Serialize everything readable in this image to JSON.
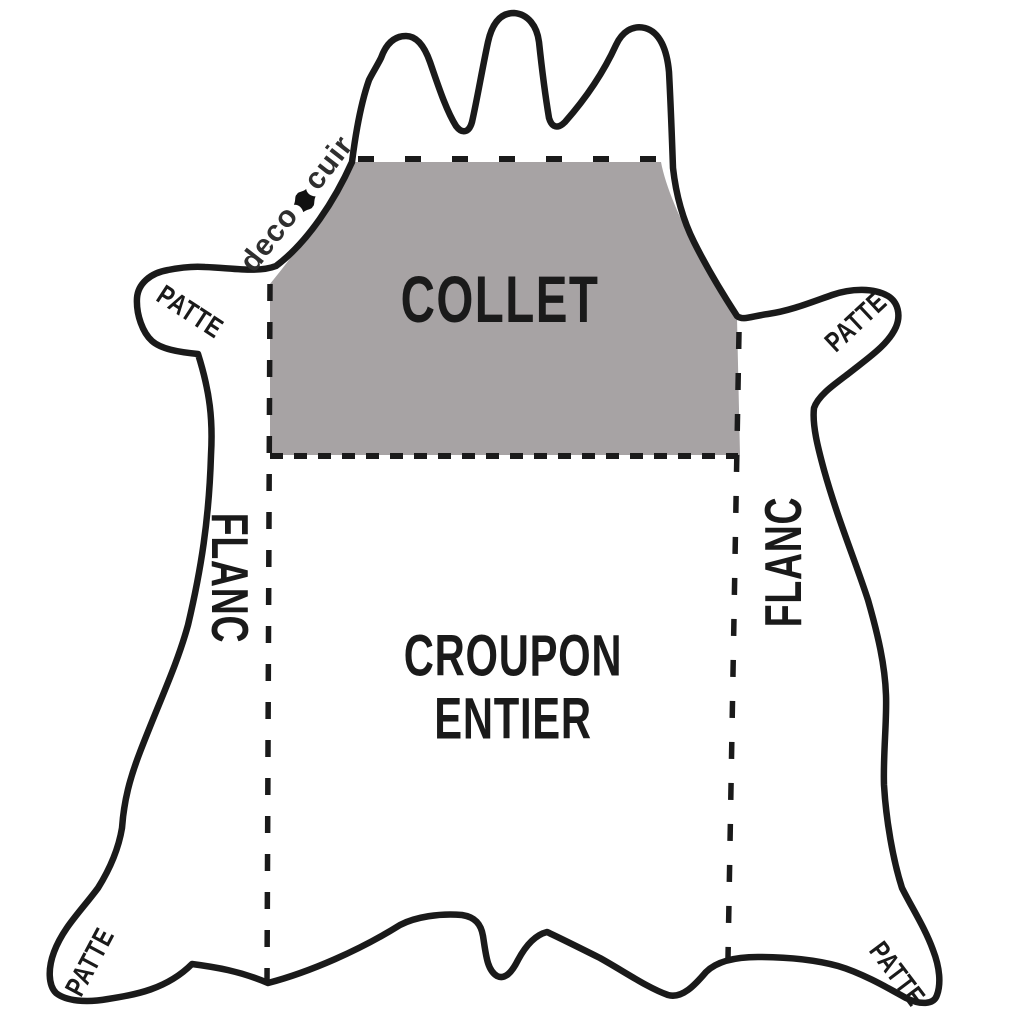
{
  "diagram": {
    "subject": "leather-hide-cut-zones",
    "regions": {
      "collet": {
        "label": "COLLET"
      },
      "croupon": {
        "label_line1": "CROUPON",
        "label_line2": "ENTIER"
      },
      "flanc_left": {
        "label": "FLANC"
      },
      "flanc_right": {
        "label": "FLANC"
      },
      "patte_top_left": {
        "label": "PATTE"
      },
      "patte_top_right": {
        "label": "PATTE"
      },
      "patte_bottom_left": {
        "label": "PATTE"
      },
      "patte_bottom_right": {
        "label": "PATTE"
      }
    }
  },
  "logo": {
    "part1": "deco",
    "part2": "cuir",
    "icon": "hide-blob-icon"
  },
  "colors": {
    "background": "#ffffff",
    "outline": "#1a1a1a",
    "collet_fill": "#a7a3a4",
    "label_text": "#1a1a1a",
    "logo_text": "#2f2f2f"
  }
}
